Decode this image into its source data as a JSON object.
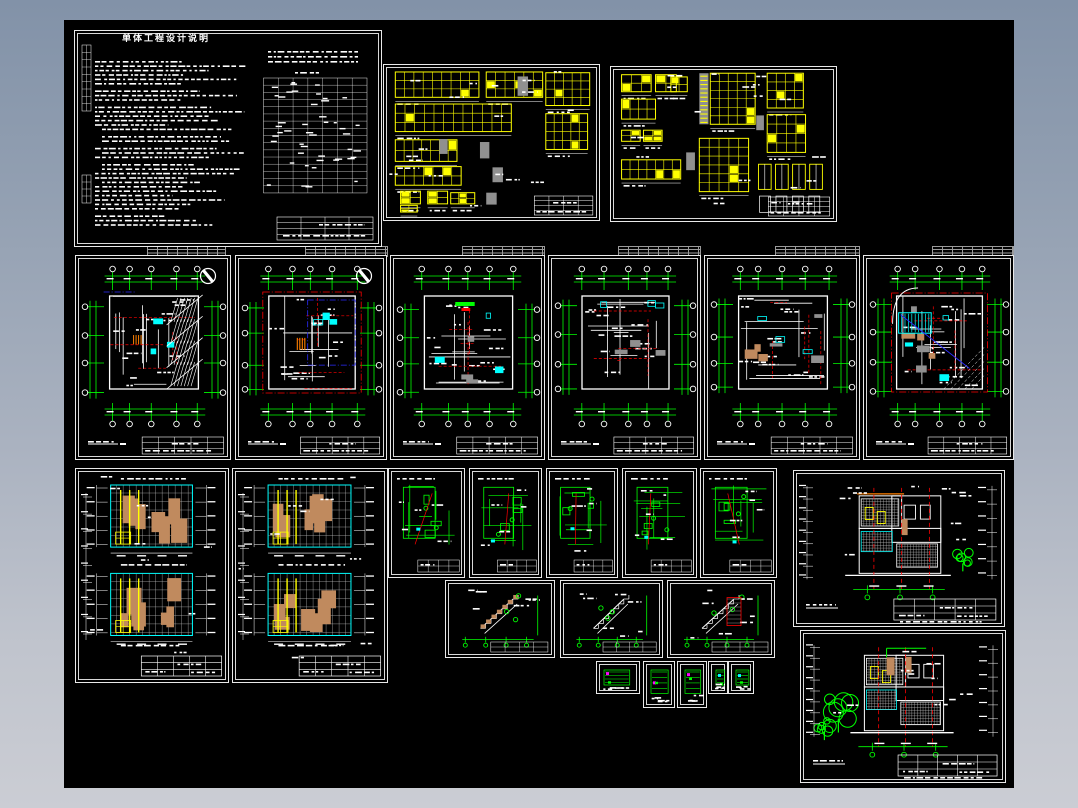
{
  "app": {
    "description": "CAD multi-sheet architectural drawing preview on black model space",
    "background_top": "#8292A8",
    "background_bottom": "#CBCDD4"
  },
  "canvas": {
    "x": 64,
    "y": 20,
    "width": 950,
    "height": 768,
    "color": "#000000"
  },
  "palette": {
    "white": "#FFFFFF",
    "green": "#00FF00",
    "red": "#FF0000",
    "cyan": "#00FFFF",
    "yellow": "#FFFF00",
    "blue": "#2B2BFF",
    "gray": "#909090",
    "tan": "#C08A5E",
    "magenta": "#FF00FF",
    "orange": "#FF8000",
    "hatch": "#C9C9C9",
    "sheet_border": "#E9E9E9"
  },
  "notes": {
    "title": "单体工程设计说明"
  },
  "sheets": [
    {
      "id": "notes",
      "name": "sheet-design-notes",
      "type": "notes",
      "x": 74,
      "y": 30,
      "w": 308,
      "h": 217,
      "variant": 0
    },
    {
      "id": "win1",
      "name": "sheet-door-window-schedule-1",
      "type": "windows",
      "x": 383,
      "y": 64,
      "w": 217,
      "h": 157,
      "variant": 0
    },
    {
      "id": "win2",
      "name": "sheet-door-window-schedule-2",
      "type": "windows",
      "x": 610,
      "y": 66,
      "w": 227,
      "h": 156,
      "variant": 1
    },
    {
      "id": "plan1",
      "name": "sheet-floor-plan-1",
      "type": "plan",
      "x": 75,
      "y": 255,
      "w": 156,
      "h": 205,
      "variant": 0
    },
    {
      "id": "plan2",
      "name": "sheet-floor-plan-2",
      "type": "plan",
      "x": 235,
      "y": 255,
      "w": 152,
      "h": 205,
      "variant": 1
    },
    {
      "id": "plan3",
      "name": "sheet-floor-plan-3",
      "type": "plan",
      "x": 390,
      "y": 255,
      "w": 155,
      "h": 205,
      "variant": 2
    },
    {
      "id": "plan4",
      "name": "sheet-floor-plan-4",
      "type": "plan",
      "x": 548,
      "y": 255,
      "w": 153,
      "h": 205,
      "variant": 3
    },
    {
      "id": "plan5",
      "name": "sheet-floor-plan-5",
      "type": "plan",
      "x": 704,
      "y": 255,
      "w": 156,
      "h": 205,
      "variant": 4
    },
    {
      "id": "plan6",
      "name": "sheet-roof-plan",
      "type": "plan",
      "x": 863,
      "y": 255,
      "w": 151,
      "h": 205,
      "variant": 5
    },
    {
      "id": "elevL1",
      "name": "sheet-elevation-left-1",
      "type": "elev_tan",
      "x": 75,
      "y": 468,
      "w": 154,
      "h": 215,
      "variant": 0
    },
    {
      "id": "elevL2",
      "name": "sheet-elevation-left-2",
      "type": "elev_tan",
      "x": 232,
      "y": 468,
      "w": 156,
      "h": 215,
      "variant": 1
    },
    {
      "id": "det1",
      "name": "sheet-detail-1",
      "type": "detail",
      "x": 388,
      "y": 468,
      "w": 77,
      "h": 110,
      "variant": 0
    },
    {
      "id": "det2",
      "name": "sheet-detail-2",
      "type": "detail",
      "x": 469,
      "y": 468,
      "w": 73,
      "h": 110,
      "variant": 1
    },
    {
      "id": "det3",
      "name": "sheet-detail-3",
      "type": "detail",
      "x": 546,
      "y": 468,
      "w": 72,
      "h": 110,
      "variant": 2
    },
    {
      "id": "det4",
      "name": "sheet-detail-4",
      "type": "detail",
      "x": 622,
      "y": 468,
      "w": 75,
      "h": 110,
      "variant": 3
    },
    {
      "id": "det5",
      "name": "sheet-detail-5",
      "type": "detail",
      "x": 700,
      "y": 468,
      "w": 77,
      "h": 110,
      "variant": 4
    },
    {
      "id": "stair1",
      "name": "sheet-stair-detail-1",
      "type": "stair",
      "x": 445,
      "y": 580,
      "w": 110,
      "h": 78,
      "variant": 0
    },
    {
      "id": "stair2",
      "name": "sheet-stair-detail-2",
      "type": "stair",
      "x": 560,
      "y": 580,
      "w": 103,
      "h": 78,
      "variant": 1
    },
    {
      "id": "stair3",
      "name": "sheet-stair-detail-3",
      "type": "stair",
      "x": 667,
      "y": 580,
      "w": 108,
      "h": 78,
      "variant": 2
    },
    {
      "id": "tiny1",
      "name": "sheet-node-detail-1",
      "type": "tiny",
      "x": 596,
      "y": 661,
      "w": 44,
      "h": 33,
      "variant": 0
    },
    {
      "id": "tiny2",
      "name": "sheet-node-detail-2",
      "type": "tiny",
      "x": 643,
      "y": 661,
      "w": 32,
      "h": 47,
      "variant": 1
    },
    {
      "id": "tiny3",
      "name": "sheet-node-detail-3",
      "type": "tiny",
      "x": 677,
      "y": 661,
      "w": 30,
      "h": 47,
      "variant": 2
    },
    {
      "id": "tiny4",
      "name": "sheet-node-detail-4",
      "type": "tiny",
      "x": 708,
      "y": 661,
      "w": 20,
      "h": 33,
      "variant": 3
    },
    {
      "id": "tiny5",
      "name": "sheet-node-detail-5",
      "type": "tiny",
      "x": 728,
      "y": 661,
      "w": 26,
      "h": 33,
      "variant": 4
    },
    {
      "id": "elevR1",
      "name": "sheet-elevation-right-1",
      "type": "elev_r",
      "x": 793,
      "y": 470,
      "w": 212,
      "h": 157,
      "variant": 0
    },
    {
      "id": "elevR2",
      "name": "sheet-elevation-right-2",
      "type": "elev_r",
      "x": 800,
      "y": 630,
      "w": 206,
      "h": 153,
      "variant": 1
    }
  ],
  "slivers": [
    {
      "x": 147,
      "y": 246,
      "w": 79,
      "h": 11
    },
    {
      "x": 305,
      "y": 246,
      "w": 83,
      "h": 11
    },
    {
      "x": 462,
      "y": 246,
      "w": 83,
      "h": 11
    },
    {
      "x": 618,
      "y": 246,
      "w": 83,
      "h": 11
    },
    {
      "x": 775,
      "y": 246,
      "w": 85,
      "h": 11
    },
    {
      "x": 932,
      "y": 246,
      "w": 82,
      "h": 11
    }
  ]
}
